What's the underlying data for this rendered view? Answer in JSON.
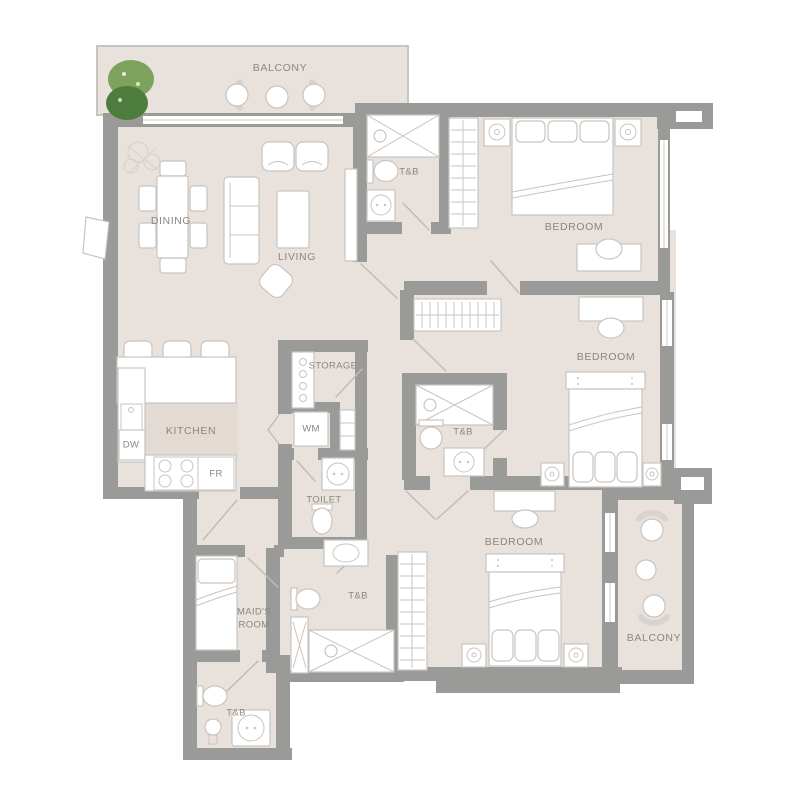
{
  "plan": {
    "colors": {
      "floor": "#e9e1dc",
      "wall": "#9a9b99",
      "furniture_stroke": "#c9c4c0",
      "label": "#8b8681",
      "door": "#c1bbb5",
      "window_line": "#cfcac6",
      "kitchen_mat": "#e3dad4",
      "balcony_outline": "#c8c4c0",
      "plant_dark": "#4e7c3c",
      "plant_light": "#7ca25c"
    },
    "rooms": {
      "balcony_top": {
        "label": "BALCONY"
      },
      "dining": {
        "label": "DINING"
      },
      "living": {
        "label": "LIVING"
      },
      "tb_1": {
        "label": "T&B"
      },
      "bedroom_1": {
        "label": "BEDROOM"
      },
      "bedroom_2": {
        "label": "BEDROOM"
      },
      "storage": {
        "label": "STORAGE"
      },
      "kitchen": {
        "label": "KITCHEN"
      },
      "dishwasher": {
        "label": "DW"
      },
      "fridge": {
        "label": "FR"
      },
      "washing_machine": {
        "label": "WM"
      },
      "tb_2": {
        "label": "T&B"
      },
      "toilet": {
        "label": "TOILET"
      },
      "maids_room": {
        "line1": "MAID'S",
        "line2": "ROOM"
      },
      "tb_3": {
        "label": "T&B"
      },
      "bedroom_3": {
        "label": "BEDROOM"
      },
      "tb_4": {
        "label": "T&B"
      },
      "balcony_bottom": {
        "label": "BALCONY"
      }
    }
  }
}
